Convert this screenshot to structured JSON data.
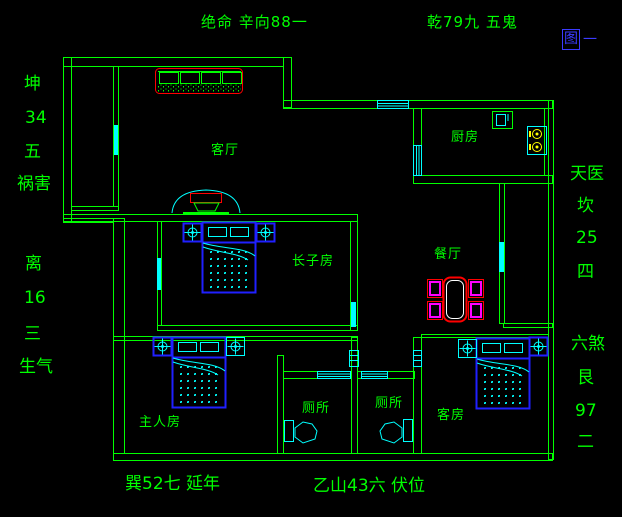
{
  "figure": {
    "caption_boxed": "图",
    "caption_suffix": "一"
  },
  "perimeter": {
    "top_left": "绝命 辛向88一",
    "top_right": "乾79九 五鬼",
    "left_upper": [
      "坤",
      "34",
      "五",
      "祸害"
    ],
    "left_lower": [
      "离",
      "16",
      "三",
      "生气"
    ],
    "right_upper": [
      "天医",
      "坎",
      "25",
      "四"
    ],
    "right_lower": [
      "六煞",
      "艮",
      "97",
      "二"
    ],
    "bottom_left": "巽52七 延年",
    "bottom_center": "乙山43六 伏位"
  },
  "rooms": {
    "living": "客厅",
    "kitchen": "厨房",
    "dining": "餐厅",
    "eldest_son": "长子房",
    "master": "主人房",
    "toilet_left": "厕所",
    "toilet_right": "厕所",
    "guest": "客房"
  },
  "colors": {
    "background": "#000000",
    "wall_green": "#00ff00",
    "fixture_cyan": "#00ffff",
    "furniture_blue": "#2020ff",
    "accent_red": "#ff0000",
    "chair_magenta": "#ff00ff",
    "burner_yellow": "#ffff00",
    "caption_blue": "#3b3bff",
    "table_inner_white": "#ffffff"
  }
}
